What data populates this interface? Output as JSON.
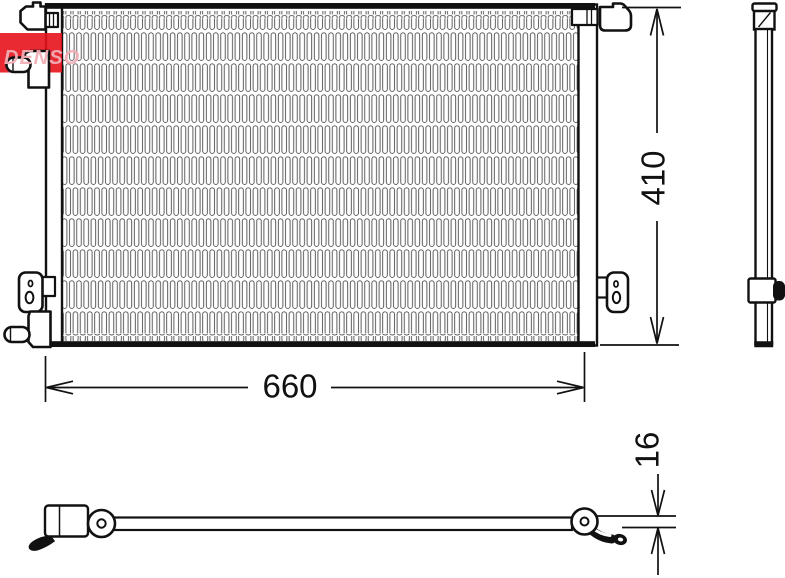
{
  "brand": {
    "logo_text": "DENSO",
    "logo_color": "#e7131d",
    "logo_text_color": "#f2aeb6"
  },
  "drawing": {
    "dimensions": {
      "width_label": "660",
      "height_label": "410",
      "depth_label": "16"
    },
    "colors": {
      "outline": "#111111",
      "fin": "#4d4d4d",
      "background": "#ffffff"
    }
  }
}
